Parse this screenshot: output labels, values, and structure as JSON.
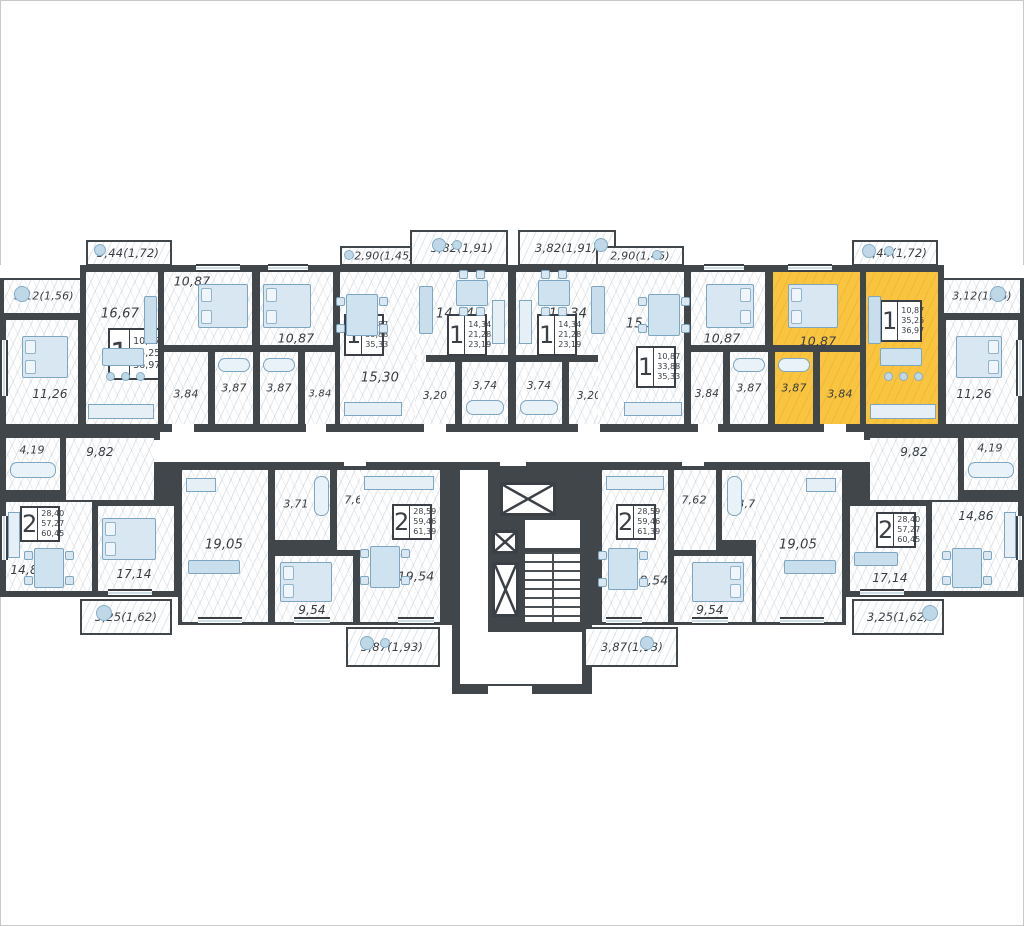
{
  "plan": {
    "highlight_color": "#F9C440",
    "wall_color": "#41464B",
    "rooms": {
      "r_bal312L": "3,12(1,56)",
      "r_11_26L": "11,26",
      "r_balA344": "3,44(1,72)",
      "r_16_67L": "16,67",
      "r_10_87La": "10,87",
      "r_hallA": "3,84",
      "r_bathA": "3,87",
      "r_bathB": "3,87",
      "r_hallB": "3,84",
      "r_10_87Lb": "10,87",
      "r_15_30L": "15,30",
      "r_balB290": "2,90(1,45)",
      "r_balC382": "3,82(1,91)",
      "r_14_34L": "14,34",
      "r_hallC": "3,20",
      "r_bathC": "3,74",
      "r_balD382": "3,82(1,91)",
      "r_14_34R": "14,34",
      "r_bathD": "3,74",
      "r_hallD": "3,20",
      "r_balE290": "2,90(1,45)",
      "r_15_30R": "15,30",
      "r_10_87Rb": "10,87",
      "r_hallE": "3,84",
      "r_bathE": "3,87",
      "r_bathF": "3,87",
      "r_hallF": "3,84",
      "r_10_87Ry": "10,87",
      "r_16_67R": "16,67",
      "r_balF344": "3,44(1,72)",
      "r_bal312R": "3,12(1,56)",
      "r_11_26R": "11,26",
      "r_bath419L": "4,19",
      "r_hall982L": "9,82",
      "r_14_86L": "14,86",
      "r_17_14L": "17,14",
      "r_bal325L": "3,25(1,62)",
      "r_19_05L": "19,05",
      "r_bath371L": "3,71",
      "r_hall762L": "7,62",
      "r_9_54L": "9,54",
      "r_19_54L": "19,54",
      "r_balG387": "3,87(1,93)",
      "r_19_54R": "19,54",
      "r_balH387": "3,87(1,93)",
      "r_hall762R": "7,62",
      "r_bath371R": "3,71",
      "r_9_54R": "9,54",
      "r_19_05R": "19,05",
      "r_hall982R": "9,82",
      "r_bath419R": "4,19",
      "r_17_14R": "17,14",
      "r_14_86R": "14,86",
      "r_bal325R": "3,25(1,62)"
    },
    "apartments": {
      "A": {
        "count": "1",
        "areas": [
          "10,87",
          "35,25",
          "36,97"
        ]
      },
      "B": {
        "count": "1",
        "areas": [
          "10,87",
          "33,88",
          "35,33"
        ]
      },
      "C": {
        "count": "1",
        "areas": [
          "14,34",
          "21,28",
          "23,19"
        ]
      },
      "D": {
        "count": "1",
        "areas": [
          "14,34",
          "21,28",
          "23,19"
        ]
      },
      "E": {
        "count": "1",
        "areas": [
          "10,87",
          "33,88",
          "35,33"
        ]
      },
      "F": {
        "count": "1",
        "areas": [
          "10,87",
          "35,25",
          "36,97"
        ]
      },
      "G2L": {
        "count": "2",
        "areas": [
          "28,40",
          "57,27",
          "60,45"
        ]
      },
      "G": {
        "count": "2",
        "areas": [
          "28,59",
          "59,46",
          "61,39"
        ]
      },
      "H": {
        "count": "2",
        "areas": [
          "28,59",
          "59,46",
          "61,39"
        ]
      },
      "G2R": {
        "count": "2",
        "areas": [
          "28,40",
          "57,27",
          "60,45"
        ]
      }
    }
  }
}
